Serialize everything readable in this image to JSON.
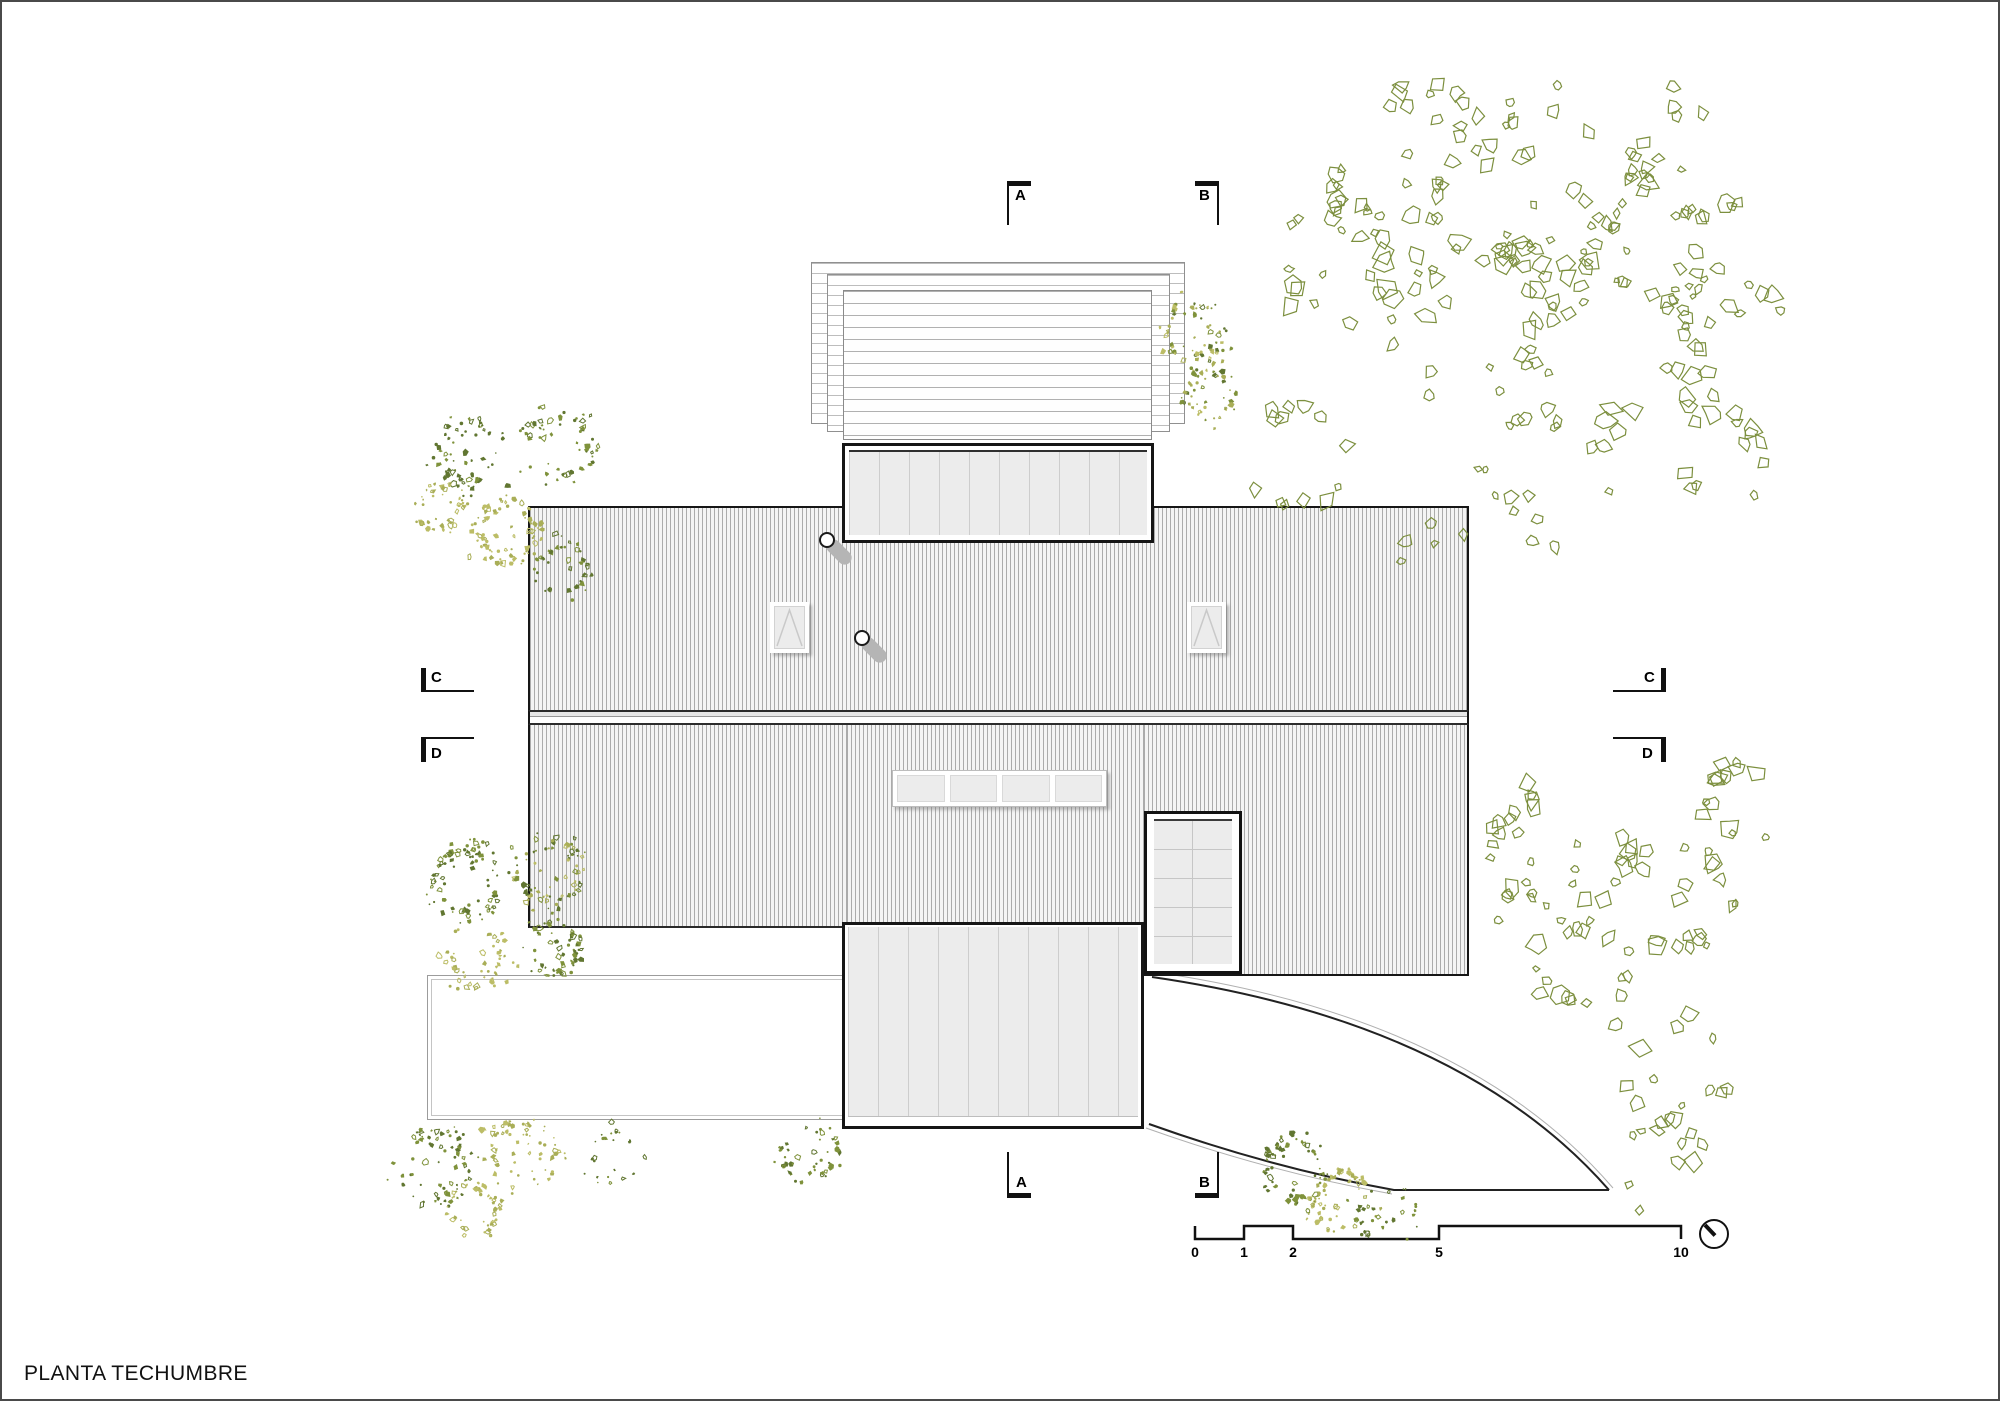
{
  "sheet": {
    "title": "PLANTA TECHUMBRE"
  },
  "markers": {
    "top_a": "A",
    "top_b": "B",
    "bottom_a": "A",
    "bottom_b": "B",
    "left_c": "C",
    "left_d": "D",
    "right_c": "C",
    "right_d": "D"
  },
  "scale_bar": {
    "ticks": [
      "0",
      "1",
      "2",
      "5",
      "10"
    ],
    "units_shown": [
      "0",
      "1",
      "2",
      "5",
      "10"
    ]
  },
  "colors": {
    "sheet_border": "#4a4a4a",
    "line_dark": "#161616",
    "hatch_line": "#ababab",
    "hatch_bg": "#f4f4f4",
    "panel_fill": "#ececec",
    "plank_line": "#cdcdcd",
    "shadow_gray": "#b5b5b5"
  },
  "vegetation": {
    "canopy_stroke": "#7c8f3e",
    "shrub_greens": [
      "#7f923b",
      "#617631"
    ],
    "shrub_yellows": [
      "#bcbd66",
      "#a9ae57"
    ],
    "clusters": [
      {
        "type": "canopy",
        "x": 1390,
        "y": 160,
        "r": 72,
        "density": 1,
        "seed": 1
      },
      {
        "type": "canopy",
        "x": 1545,
        "y": 185,
        "r": 85,
        "density": 1,
        "seed": 2
      },
      {
        "type": "canopy",
        "x": 1690,
        "y": 165,
        "r": 60,
        "density": 0.9,
        "seed": 3
      },
      {
        "type": "canopy",
        "x": 1330,
        "y": 265,
        "r": 55,
        "density": 0.8,
        "seed": 4
      },
      {
        "type": "canopy",
        "x": 1470,
        "y": 320,
        "r": 80,
        "density": 0.9,
        "seed": 5
      },
      {
        "type": "canopy",
        "x": 1625,
        "y": 345,
        "r": 80,
        "density": 0.9,
        "seed": 6
      },
      {
        "type": "canopy",
        "x": 1730,
        "y": 265,
        "r": 50,
        "density": 0.7,
        "seed": 7
      },
      {
        "type": "canopy",
        "x": 1545,
        "y": 475,
        "r": 65,
        "density": 0.5,
        "seed": 8
      },
      {
        "type": "canopy",
        "x": 1300,
        "y": 455,
        "r": 55,
        "density": 0.45,
        "seed": 9
      },
      {
        "type": "canopy",
        "x": 1440,
        "y": 550,
        "r": 40,
        "density": 0.35,
        "seed": 10
      },
      {
        "type": "canopy",
        "x": 1725,
        "y": 455,
        "r": 45,
        "density": 0.4,
        "seed": 16
      },
      {
        "type": "canopy",
        "x": 1560,
        "y": 845,
        "r": 70,
        "density": 0.9,
        "seed": 11
      },
      {
        "type": "canopy",
        "x": 1665,
        "y": 895,
        "r": 62,
        "density": 0.85,
        "seed": 12
      },
      {
        "type": "canopy",
        "x": 1740,
        "y": 800,
        "r": 40,
        "density": 0.5,
        "seed": 17
      },
      {
        "type": "canopy",
        "x": 1580,
        "y": 965,
        "r": 50,
        "density": 0.5,
        "seed": 13
      },
      {
        "type": "canopy",
        "x": 1675,
        "y": 1065,
        "r": 55,
        "density": 0.45,
        "seed": 14
      },
      {
        "type": "canopy",
        "x": 1655,
        "y": 1165,
        "r": 45,
        "density": 0.4,
        "seed": 15
      },
      {
        "type": "shrub",
        "x": 470,
        "y": 452,
        "r": 36,
        "tone": "green",
        "seed": 21
      },
      {
        "type": "shrub",
        "x": 557,
        "y": 446,
        "r": 38,
        "tone": "green",
        "seed": 22
      },
      {
        "type": "shrub",
        "x": 437,
        "y": 505,
        "r": 24,
        "tone": "yellow",
        "seed": 23
      },
      {
        "type": "shrub",
        "x": 505,
        "y": 530,
        "r": 34,
        "tone": "yellow",
        "seed": 24
      },
      {
        "type": "shrub",
        "x": 562,
        "y": 566,
        "r": 28,
        "tone": "green",
        "seed": 25
      },
      {
        "type": "shrub",
        "x": 1190,
        "y": 330,
        "r": 32,
        "tone": "mixed",
        "seed": 26
      },
      {
        "type": "shrub",
        "x": 1206,
        "y": 392,
        "r": 27,
        "tone": "mixed",
        "seed": 27
      },
      {
        "type": "shrub",
        "x": 465,
        "y": 882,
        "r": 38,
        "tone": "green",
        "seed": 28
      },
      {
        "type": "shrub",
        "x": 549,
        "y": 868,
        "r": 34,
        "tone": "mixed",
        "seed": 29
      },
      {
        "type": "shrub",
        "x": 472,
        "y": 952,
        "r": 34,
        "tone": "yellow",
        "seed": 30
      },
      {
        "type": "shrub",
        "x": 553,
        "y": 947,
        "r": 28,
        "tone": "green",
        "seed": 31
      },
      {
        "type": "shrub",
        "x": 430,
        "y": 1165,
        "r": 40,
        "tone": "green",
        "seed": 32
      },
      {
        "type": "shrub",
        "x": 520,
        "y": 1152,
        "r": 36,
        "tone": "yellow",
        "seed": 33
      },
      {
        "type": "shrub",
        "x": 608,
        "y": 1156,
        "r": 28,
        "tone": "green",
        "seed": 34
      },
      {
        "type": "shrub",
        "x": 472,
        "y": 1208,
        "r": 28,
        "tone": "yellow",
        "seed": 35
      },
      {
        "type": "shrub",
        "x": 806,
        "y": 1148,
        "r": 30,
        "tone": "green",
        "seed": 36
      },
      {
        "type": "shrub",
        "x": 1295,
        "y": 1168,
        "r": 34,
        "tone": "green",
        "seed": 37
      },
      {
        "type": "shrub",
        "x": 1340,
        "y": 1198,
        "r": 32,
        "tone": "yellow",
        "seed": 38
      },
      {
        "type": "shrub",
        "x": 1385,
        "y": 1212,
        "r": 30,
        "tone": "green",
        "seed": 39
      }
    ]
  }
}
